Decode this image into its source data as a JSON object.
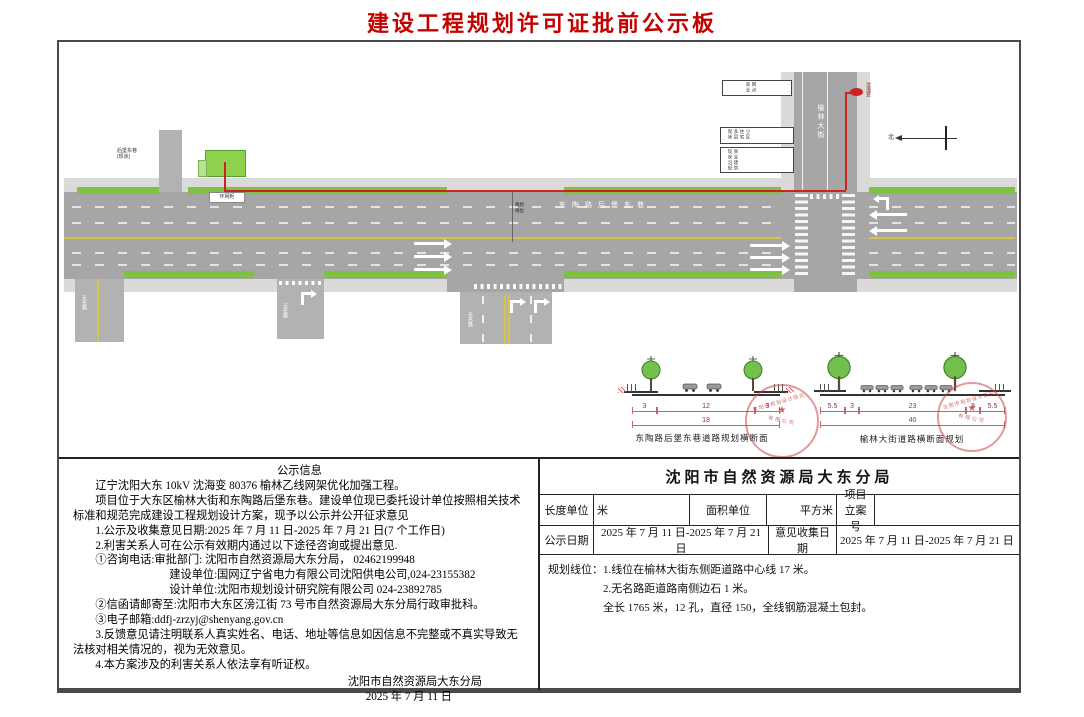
{
  "title": "建设工程规划许可证批前公示板",
  "plan": {
    "main_road_label": "东陶路后堡东巷",
    "vertical_road_label": "榆林大街",
    "unnamed_road_label": "无名路",
    "equipment_label": "环网柜",
    "substation_label": "沈海变",
    "north_label": "北",
    "marker_label": "规划线位",
    "side_street_label": "后堡东巷",
    "side_street_note": "(现状)",
    "building_boxes": {
      "box1": "商业网点",
      "box2": "现状多层住宅小区",
      "box3": "现状沿街商业建筑"
    },
    "colors": {
      "route": "#cc2222",
      "greenbelt": "#7fc241",
      "road": "#a6a6a6",
      "center_line": "#d9c44a"
    }
  },
  "cross_sections": {
    "left": {
      "caption": "东陶路后堡东巷道路规划横断面",
      "dims": {
        "d0": "3",
        "d1": "12",
        "d2": "3"
      },
      "total": "18"
    },
    "right": {
      "caption": "榆林大街道路横断面规划",
      "dims": {
        "d0": "5.5",
        "d1": "3",
        "d2": "23",
        "d3": "3",
        "d4": "5.5"
      },
      "total": "40"
    }
  },
  "stamp": {
    "line1": "沈阳市规划设计研究院",
    "star": "★",
    "line2": "有限公司"
  },
  "notice": {
    "heading": "公示信息",
    "lines": [
      "辽宁沈阳大东 10kV 沈海变 80376 榆林乙线网架优化加强工程。",
      "项目位于大东区榆林大街和东陶路后堡东巷。建设单位现已委托设计单位按照相关技术标准和规范完成建设工程规划设计方案，现予以公示并公开征求意见",
      "1.公示及收集意见日期:2025 年 7 月 11 日-2025 年 7 月 21 日(7 个工作日)",
      "2.利害关系人可在公示有效期内通过以下途径咨询或提出意见.",
      "①咨询电话:审批部门: 沈阳市自然资源局大东分局， 02462199948",
      "建设单位:国网辽宁省电力有限公司沈阳供电公司,024-23155382",
      "设计单位:沈阳市规划设计研究院有限公司 024-23892785",
      "②信函请邮寄至:沈阳市大东区滂江街 73 号市自然资源局大东分局行政审批科。",
      "③电子邮箱:ddfj-zrzyj@shenyang.gov.cn",
      "3.反馈意见请注明联系人真实姓名、电话、地址等信息如因信息不完整或不真实导致无法核对相关情况的，视为无效意见。",
      "4.本方案涉及的利害关系人依法享有听证权。"
    ],
    "sign_org": "沈阳市自然资源局大东分局",
    "sign_date": "2025 年 7 月 11 日"
  },
  "table": {
    "header": "沈阳市自然资源局大东分局",
    "r1": {
      "c1": "长度单位",
      "v1": "米",
      "c2": "面积单位",
      "v2": "平方米",
      "c3": "项目立案号",
      "v3": ""
    },
    "r2": {
      "c1": "公示日期",
      "v1": "2025 年 7 月 11 日-2025 年 7 月 21 日",
      "c2": "意见收集日期",
      "v2": "2025 年 7 月 11 日-2025 年 7 月 21 日"
    },
    "r3": {
      "label": "规划线位：",
      "line1": "1.线位在榆林大街东侧距道路中心线 17 米。",
      "line2": "2.无名路距道路南侧边石 1 米。",
      "line3": "全长 1765 米，12 孔，直径 150，全线钢筋混凝土包封。"
    }
  }
}
